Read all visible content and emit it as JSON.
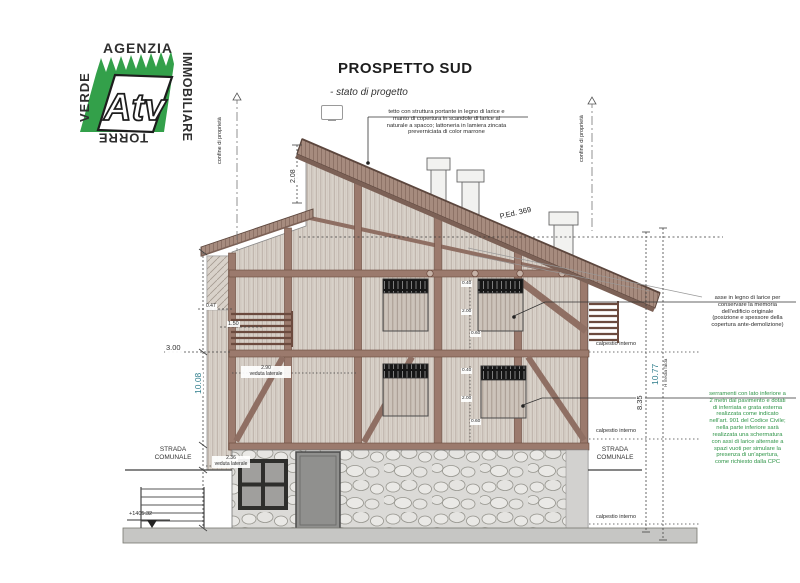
{
  "logo": {
    "word_top": "AGENZIA",
    "word_right": "IMMOBILIARE",
    "word_bottom": "TORRE",
    "word_left": "VERDE",
    "monogram": "Atv"
  },
  "title": {
    "heading": "PROSPETTO SUD",
    "subheading": "- stato di progetto"
  },
  "notes": {
    "roof": "tetto con struttura portante in legno di larice e\nmanto di copertura in scandole di larice al\nnaturale a spacco; lattoneria in lamiera zincata\npreverniciata di color marrone",
    "larch_axis": "asse in legno di larice per\nconservare la memoria\ndell'edificio originale\n(posizione e spessore della\ncopertura ante-demolizione)",
    "windows": "serramenti con lato inferiore a\n2 metri dal pavimento e dotati\ndi inferriata e grata esterna\nrealizzata come indicato\nnell'art. 901 del Codice Civile;\nnella parte inferiore sarà\nrealizzata una schermatura\ncon assi di larice alternate a\nspazi vuoti per simulare la\npresenza di un'apertura,\ncome richiesto dalla CPC"
  },
  "labels": {
    "confine_left": "confine di proprietà",
    "confine_right": "confine di proprietà",
    "parcel": "P.Ed. 369",
    "strada_left": "STRADA\nCOMUNALE",
    "strada_right": "STRADA\nCOMUNALE",
    "calpestio_1": "calpestio interno",
    "calpestio_2": "calpestio interno",
    "calpestio_3": "calpestio interno",
    "veduta_upper": "2.90\nveduta laterale",
    "veduta_basement": "2.36\nveduta laterale",
    "quota": "+1405.32"
  },
  "dims": {
    "roof_peak": "2.08",
    "left_total": "10.08",
    "left_offset": "3.00",
    "left_s1": "0.47",
    "left_s2": "1.50",
    "right_partial": "8.35",
    "right_total": "10.77",
    "right_total_note": "H media falda",
    "chain_up": [
      "0.40",
      "2.00",
      "0.60"
    ],
    "chain_low": [
      "0.40",
      "2.00",
      "0.60"
    ]
  },
  "colors": {
    "logo_green": "#33a04a",
    "note_green": "#2e9447",
    "dim_teal": "#2e7d8c",
    "roof_brown": "#a68b7e",
    "timber": "#8f6f63",
    "siding": "#d9d2ca"
  }
}
